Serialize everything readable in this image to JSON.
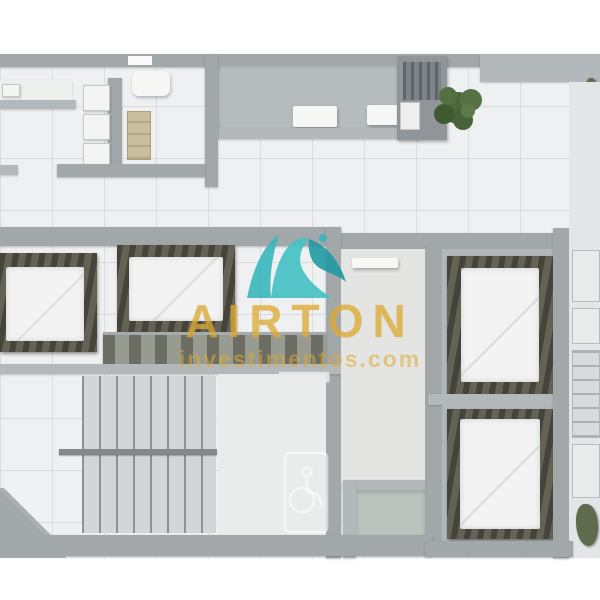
{
  "watermark": {
    "title": "AIRTON",
    "subtitle": "investimentos.com",
    "text_color": "#dbaa34",
    "logo_teal_light": "#45c1c4",
    "logo_teal_dark": "#1f9aa3"
  },
  "palette": {
    "background": "#ffffff",
    "wall_gray": "#a2a7aa",
    "wall_light_gray": "#b3b8bb",
    "floor_tile": "#eff0f1",
    "room_carpet_gray": "#b2b7ba",
    "room_warm_floor": "#e4e5e2",
    "bed_frame_wood": "#5c5a4e",
    "bedding_white": "#f2f3f2",
    "cabinet_beige": "#c9bd9c",
    "plant_green": "#4c673a",
    "stair_tread_line": "#8e9294"
  },
  "scene": {
    "type": "apartment-floor-plan-top-view",
    "features": [
      "terrace-with-benches",
      "kitchen",
      "four-bedrooms",
      "staircase",
      "accessible-bathroom",
      "closet-corridor",
      "potted-plant"
    ]
  }
}
